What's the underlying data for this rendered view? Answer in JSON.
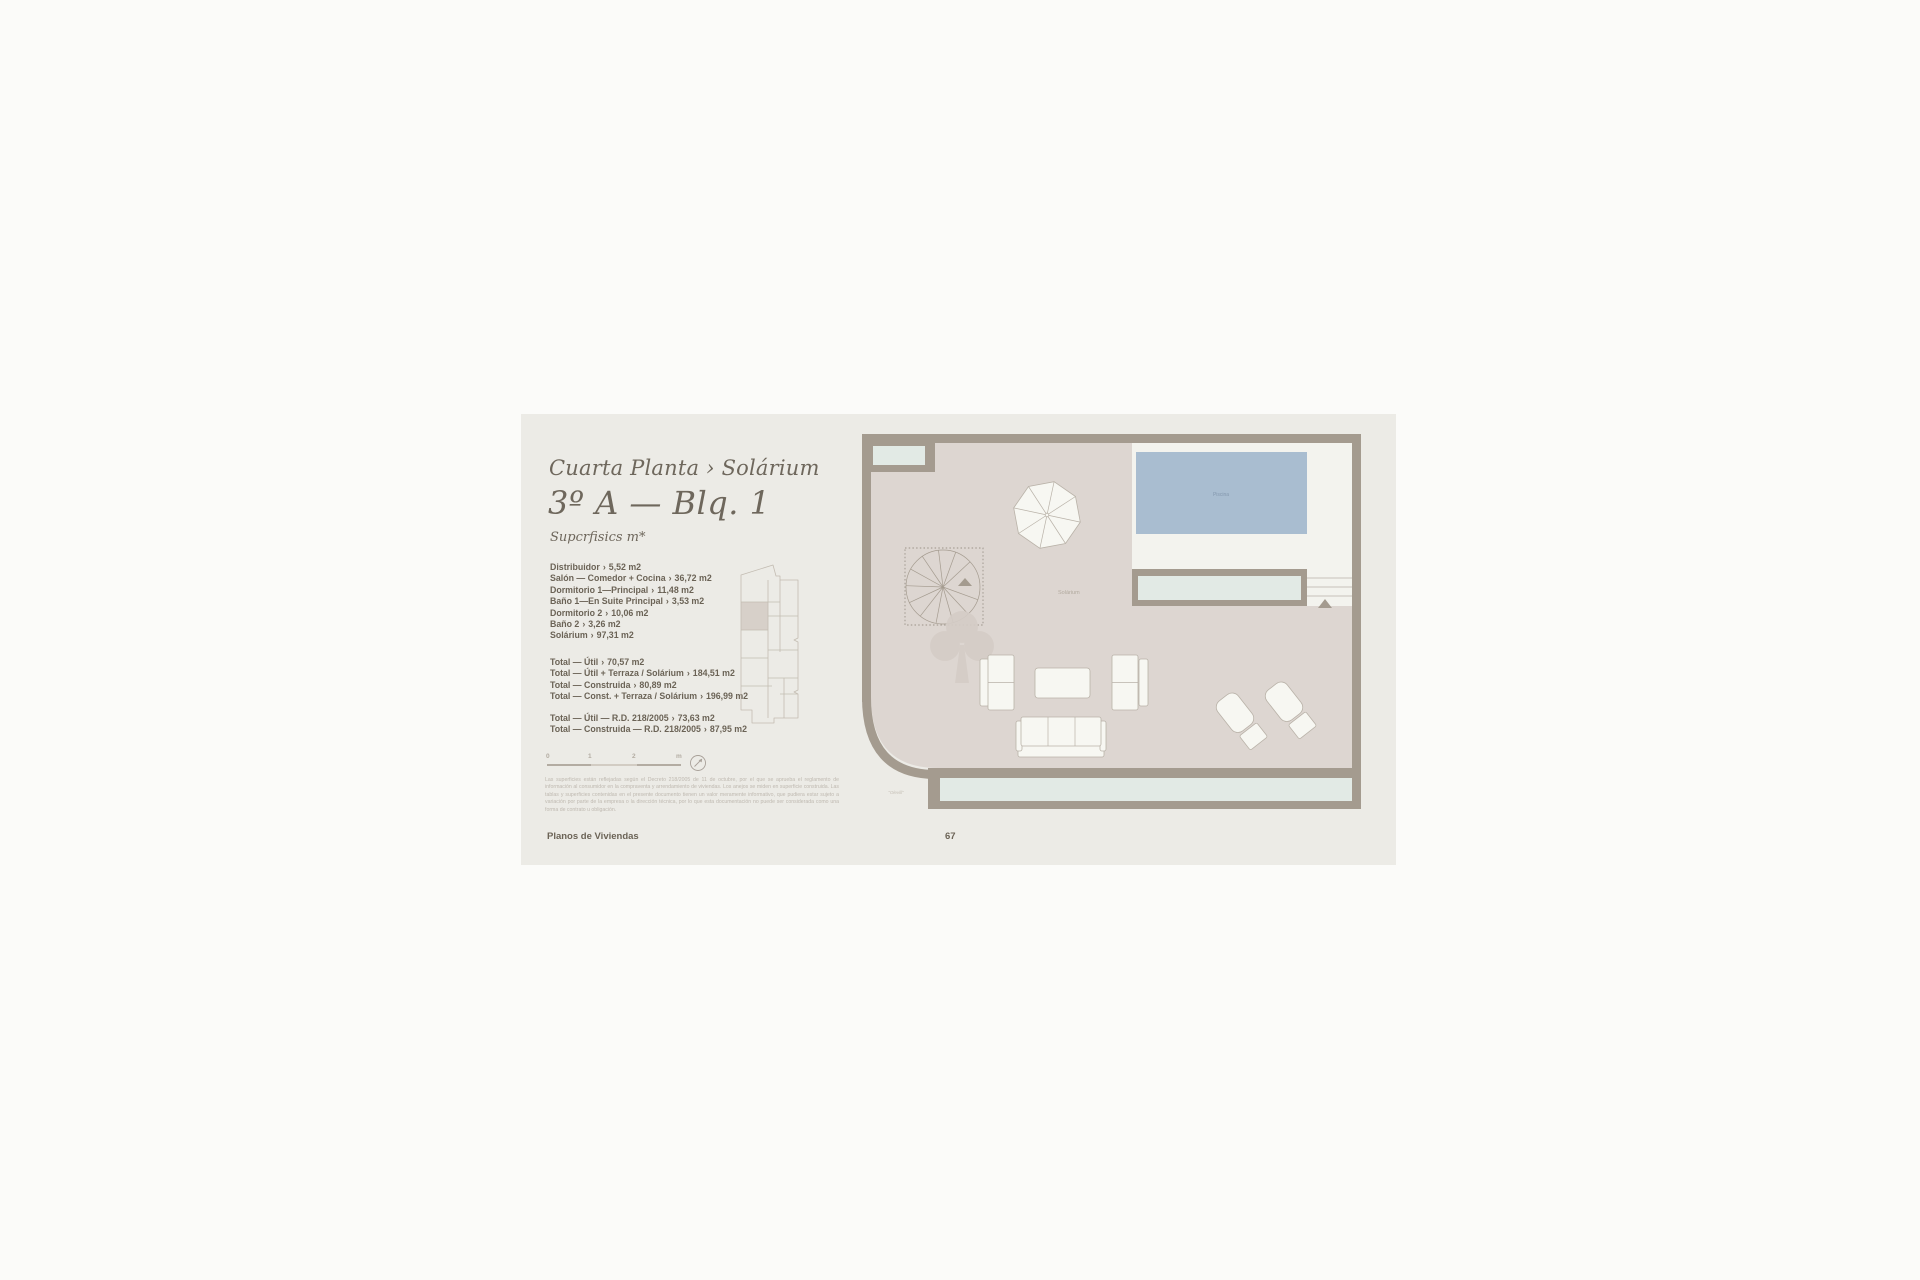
{
  "header": {
    "subtitle": "Cuarta Planta › Solárium",
    "title": "3º A — Blq. 1",
    "section_label": "Supcrfisics m*"
  },
  "areas": {
    "separator": "›",
    "rooms": [
      {
        "label": "Distribuidor",
        "value": "5,52 m2"
      },
      {
        "label": "Salón — Comedor + Cocina",
        "value": "36,72 m2"
      },
      {
        "label": "Dormitorio 1—Principal",
        "value": "11,48 m2"
      },
      {
        "label": "Baño 1—En Suite Principal",
        "value": "3,53 m2"
      },
      {
        "label": "Dormitorio 2",
        "value": "10,06 m2"
      },
      {
        "label": "Baño 2",
        "value": "3,26 m2"
      },
      {
        "label": "Solárium",
        "value": "97,31 m2"
      }
    ],
    "totals_a": [
      {
        "label": "Total — Útil",
        "value": "70,57 m2"
      },
      {
        "label": "Total — Útil + Terraza / Solárium",
        "value": "184,51 m2"
      },
      {
        "label": "Total — Construida",
        "value": "80,89 m2"
      },
      {
        "label": "Total — Const. + Terraza / Solárium",
        "value": "196,99 m2"
      }
    ],
    "totals_b": [
      {
        "label": "Total — Útil — R.D. 218/2005",
        "value": "73,63 m2"
      },
      {
        "label": "Total — Construida — R.D. 218/2005",
        "value": "87,95 m2"
      }
    ]
  },
  "scale_bar": {
    "ticks": [
      "0",
      "1",
      "2",
      "m"
    ]
  },
  "disclaimer": "Las superficies están reflejadas según el Decreto 218/2005 de 11 de octubre, por el que se aprueba el reglamento de información al consumidor en la compraventa y arrendamiento de viviendas. Los anejos se miden en superficie construida. Las tablas y superficies contenidas en el presente documento tienen un valor meramente informativo, que pudiera estar sujeto a variación por parte de la empresa o la dirección técnica, por lo que esta documentación no puede ser considerada como una forma de contrato u obligación.",
  "footer": {
    "section": "Planos de Viviendas",
    "page_number": "67"
  },
  "plan": {
    "labels": {
      "pool": "Piscina",
      "solarium": "Solárium",
      "corner_note": "\"Olevill\""
    }
  },
  "colors": {
    "canvas": "#fbfbf9",
    "sheet": "#ecebe6",
    "heading": "#6e675c",
    "body": "#6b6356",
    "faint": "#b2aa9f",
    "disclaimer": "#bcb6ad",
    "wall": "#a49b8f",
    "floor": "#ddd6d1",
    "deck": "#f3f3ee",
    "pool": "#a9bdd0",
    "pool_label": "#8498ae",
    "mint": "#e2eae5",
    "furniture": "#f7f7f2",
    "outline": "#b9b2a8",
    "watermark": "#d5cdc7",
    "keyline": "#c3bcb2",
    "key_highlight": "#d7d0c9",
    "scale_dark": "#b3aca2",
    "scale_light": "#d2ccc3"
  }
}
